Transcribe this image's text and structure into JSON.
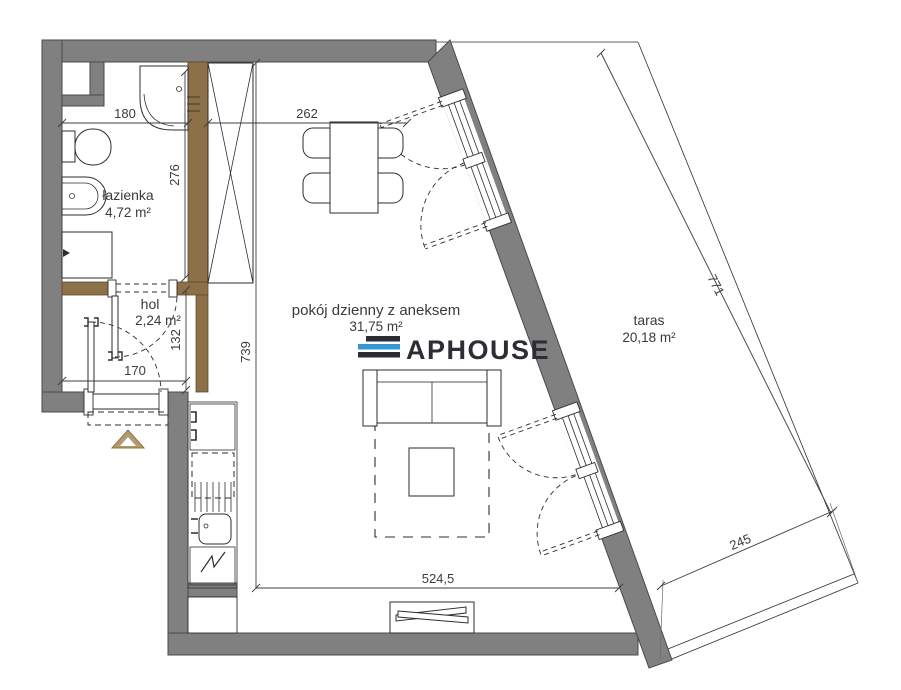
{
  "plan": {
    "rooms": [
      {
        "name": "łazienka",
        "area": "4,72 m²"
      },
      {
        "name": "hol",
        "area": "2,24 m²"
      },
      {
        "name": "pokój dzienny z aneksem",
        "area": "31,75 m²"
      },
      {
        "name": "taras",
        "area": "20,18 m²"
      }
    ],
    "dimensions": {
      "bath_width": "180",
      "dining_width": "262",
      "bath_height": "276",
      "hol_height": "132",
      "entry_width": "170",
      "room_height": "739",
      "room_width": "524,5",
      "terrace_length": "771",
      "terrace_width": "245"
    },
    "logo": {
      "text": "APHOUSE",
      "stripe_dark_color": "#2c2c34",
      "stripe_blue_color": "#3598d4"
    },
    "colors": {
      "exterior_wall": "#808080",
      "partition_wall": "#8c7047",
      "entrance_arrow": "#b49b6b"
    }
  }
}
